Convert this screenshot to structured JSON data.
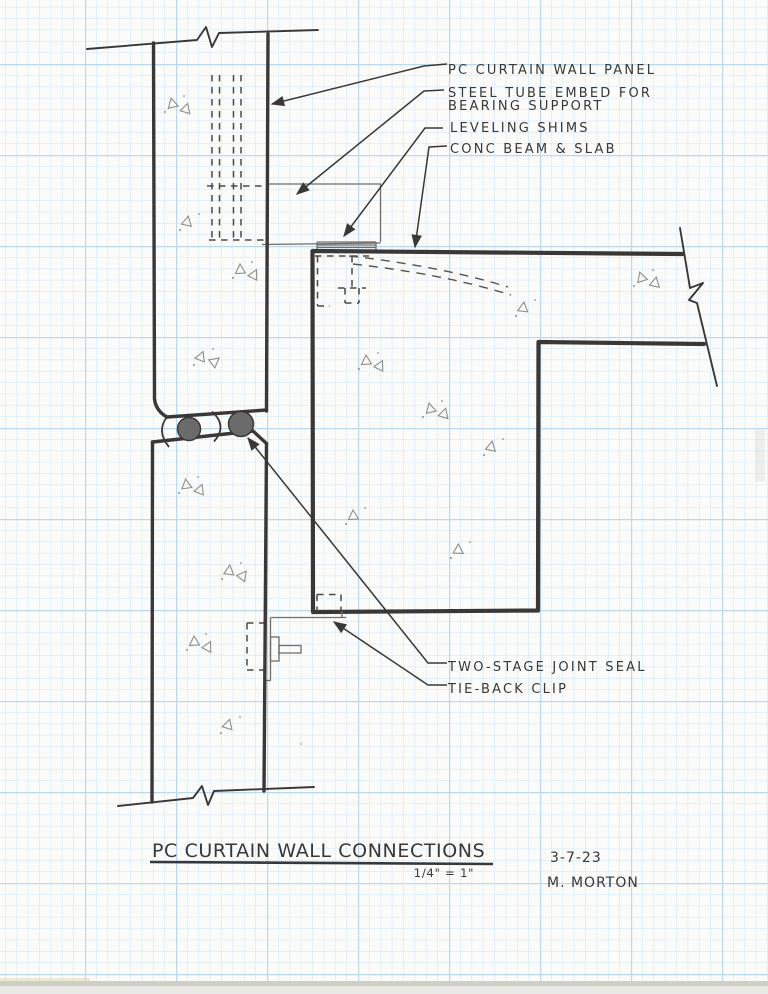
{
  "sheet": {
    "title": "PC CURTAIN WALL CONNECTIONS",
    "scale_note": "1/4\" = 1\"",
    "date": "3-7-23",
    "author": "M. MORTON"
  },
  "callouts": {
    "panel": "PC CURTAIN WALL PANEL",
    "tube_line1": "STEEL TUBE EMBED FOR",
    "tube_line2": "BEARING SUPPORT",
    "shims": "LEVELING SHIMS",
    "beam": "CONC BEAM & SLAB",
    "joint_seal": "TWO-STAGE JOINT SEAL",
    "tieback": "TIE-BACK CLIP"
  },
  "colors": {
    "pencil": "#3a3836",
    "pencil_light": "#8f8d86",
    "gasket_fill": "#6b6b6b",
    "grid_fine": "#dcecf8",
    "grid_major": "#bcd8ec",
    "paper": "#fbfcfa"
  }
}
